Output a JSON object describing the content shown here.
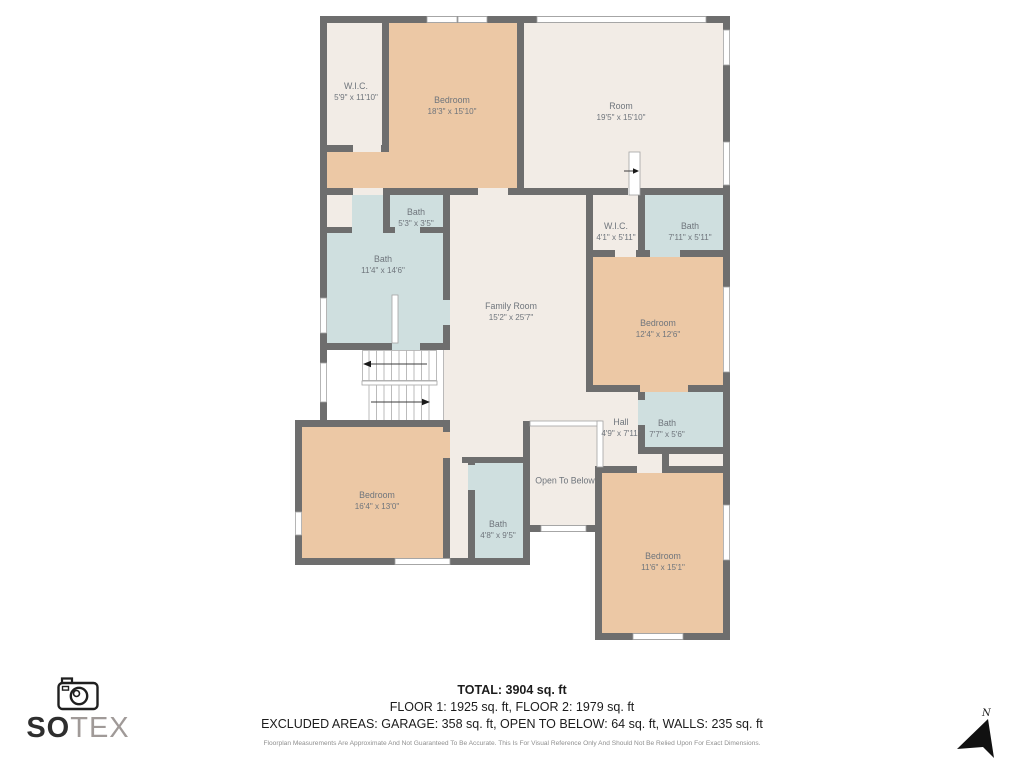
{
  "colors": {
    "wall": "#6e6e6e",
    "cream": "#f2ece6",
    "bedroom": "#ecc8a5",
    "bath": "#cfdfdf",
    "label": "#6f757c",
    "stairline": "#b4b4b4",
    "windowline": "#a3a3a3",
    "textdark": "#1c1c1c",
    "textmuted": "#8f8f8f",
    "logogray": "#a09a98"
  },
  "rooms": [
    {
      "name": "W.I.C.",
      "dims": "5'9\" x 11'10\""
    },
    {
      "name": "Bedroom",
      "dims": "18'3\" x 15'10\""
    },
    {
      "name": "Room",
      "dims": "19'5\" x 15'10\""
    },
    {
      "name": "Bath",
      "dims": "5'3\" x 3'5\""
    },
    {
      "name": "Bath",
      "dims": "11'4\" x 14'6\""
    },
    {
      "name": "Family Room",
      "dims": "15'2\" x 25'7\""
    },
    {
      "name": "W.I.C.",
      "dims": "4'1\" x 5'11\""
    },
    {
      "name": "Bath",
      "dims": "7'11\" x 5'11\""
    },
    {
      "name": "Bedroom",
      "dims": "12'4\" x 12'6\""
    },
    {
      "name": "Bedroom",
      "dims": "16'4\" x 13'0\""
    },
    {
      "name": "Bath",
      "dims": "4'8\" x 9'5\""
    },
    {
      "name": "Open To Below",
      "dims": ""
    },
    {
      "name": "Hall",
      "dims": "4'9\" x 7'11\""
    },
    {
      "name": "Bath",
      "dims": "7'7\" x 5'6\""
    },
    {
      "name": "Bedroom",
      "dims": "11'6\" x 15'1\""
    }
  ],
  "summary": {
    "total": "TOTAL: 3904 sq. ft",
    "floors": "FLOOR 1: 1925 sq. ft, FLOOR 2: 1979 sq. ft",
    "excluded": "EXCLUDED AREAS: GARAGE: 358 sq. ft, OPEN TO BELOW: 64 sq. ft, WALLS: 235 sq. ft",
    "disclaimer": "Floorplan Measurements Are Approximate And Not Guaranteed To Be Accurate. This Is For Visual Reference Only And Should Not Be Relied Upon For Exact Dimensions."
  },
  "branding": {
    "primary": "SO",
    "secondary": "TEX"
  },
  "compass": {
    "north_label": "N"
  }
}
